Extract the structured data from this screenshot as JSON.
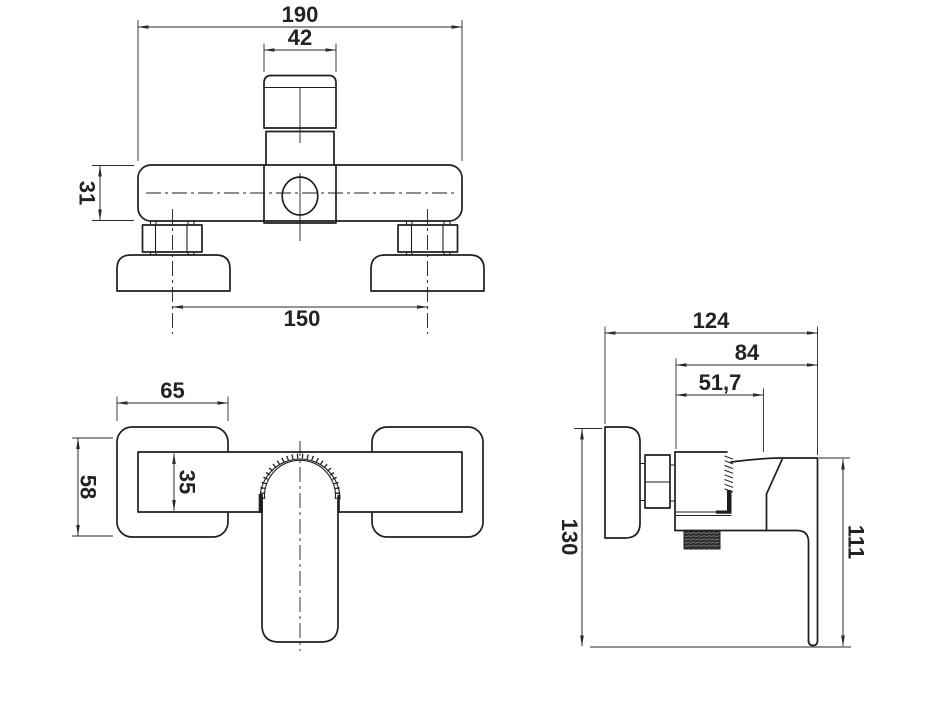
{
  "drawing": {
    "type": "technical-orthographic-views",
    "subject": "wall-mounted shower mixer tap",
    "background_color": "#ffffff",
    "line_color": "#1f1f1f",
    "text_color": "#222222"
  },
  "front_view": {
    "dims": {
      "total_width": "190",
      "handle_width": "42",
      "body_height": "31",
      "mount_spacing": "150"
    }
  },
  "top_view": {
    "dims": {
      "escutcheon_width": "65",
      "escutcheon_height": "58",
      "body_depth": "35"
    }
  },
  "side_view": {
    "dims": {
      "total_depth": "124",
      "body_depth": "84",
      "front_depth": "51,7",
      "total_height": "130",
      "handle_height": "111"
    }
  }
}
